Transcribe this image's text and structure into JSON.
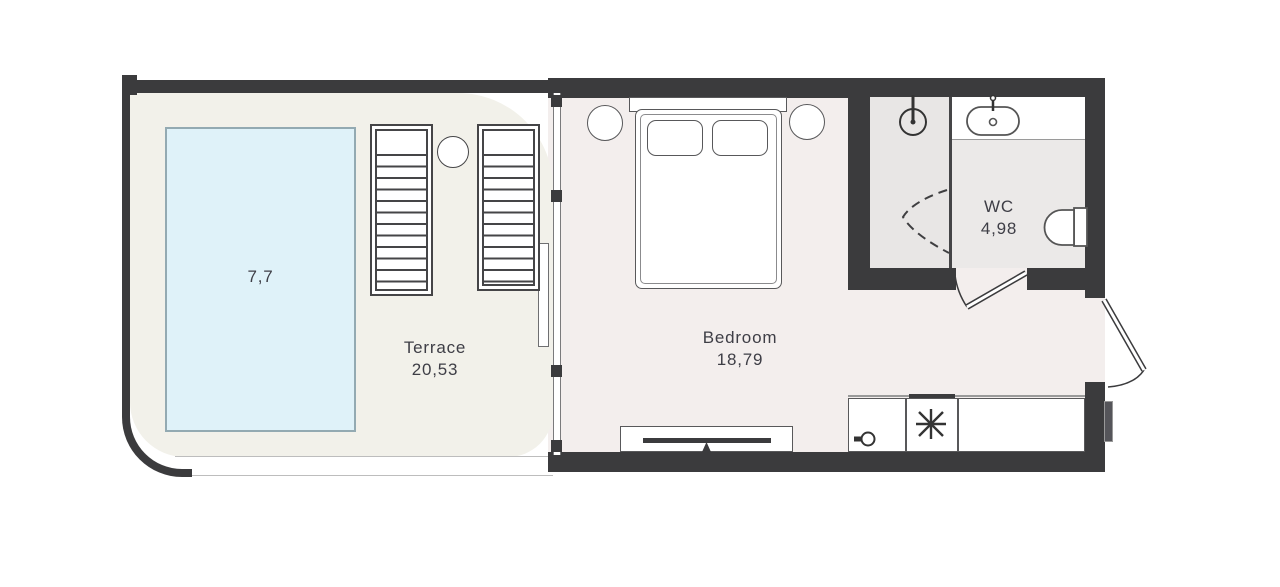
{
  "title": "Studio apartment floor plan",
  "rooms": {
    "terrace": {
      "label": "Terrace",
      "area": "20,53"
    },
    "pool": {
      "area": "7,7"
    },
    "bedroom": {
      "label": "Bedroom",
      "area": "18,79"
    },
    "wc": {
      "label": "WC",
      "area": "4,98"
    }
  },
  "fixtures": [
    "pool",
    "sun-lounger",
    "sun-lounger",
    "round-side-table",
    "sliding-glass-door",
    "double-bed",
    "pillow",
    "pillow",
    "bedside-table",
    "bedside-table",
    "tv-console",
    "tv",
    "kitchen-sink",
    "stove",
    "kitchen-counter",
    "exterior-unit",
    "shower",
    "shower-head",
    "shower-screen",
    "washbasin",
    "vanity-counter",
    "toilet",
    "wc-door",
    "entrance-door"
  ],
  "colors": {
    "wall": "#3b3b3d",
    "bedroom_floor": "#f3eeed",
    "terrace_floor": "#f2f1ea",
    "bath_floor": "#ebe9e8",
    "shower_floor": "#e8e6e5",
    "pool_fill": "#dff2f9",
    "pool_border": "#93aab2",
    "label_text": "#3e3e46"
  }
}
